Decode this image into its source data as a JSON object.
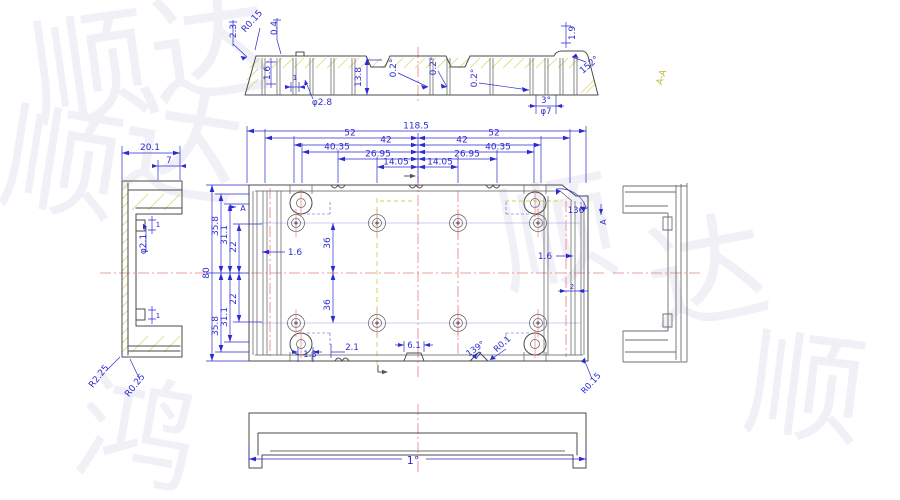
{
  "drawing": {
    "type": "cad-engineering-drawing",
    "part": "plastic-enclosure-base",
    "views": [
      "section A-A (top)",
      "left side view",
      "plan view",
      "right side view",
      "bottom view"
    ],
    "colors": {
      "dimension_blue": "#2b2bd2",
      "part_line": "#4b4b4b",
      "centerline_red": "#e87e7e",
      "hatch_yellow": "#ddd573",
      "section_label_olive": "#bdb52d",
      "construction_blue": "#9a9ae0",
      "watermark_gray": "#f1f0f7",
      "background": "#ffffff"
    }
  },
  "labels": {
    "section": {
      "d23": "2.3",
      "r015": "R0.15",
      "d04": "0.4",
      "d16": "1.6",
      "d138": "13.8",
      "d1": "1",
      "dia28": "φ2.8",
      "a02a": "0.2°",
      "a02b": "0.2°",
      "a02c": "0.2°",
      "d19": "1.9",
      "a152": "152°",
      "a3": "3°",
      "dia7": "φ7",
      "view_label": "A-A"
    },
    "left_view": {
      "d201": "20.1",
      "d7": "7",
      "dia21": "φ2.1",
      "d1t": "1",
      "d1b": "1",
      "r225": "R2.25",
      "r025": "R0.25"
    },
    "plan": {
      "d1185": "118.5",
      "d52l": "52",
      "d52r": "52",
      "d42l": "42",
      "d42r": "42",
      "d4035l": "40.35",
      "d4035r": "40.35",
      "d2695l": "26.95",
      "d2695r": "26.95",
      "d1405l": "14.05",
      "d1405r": "14.05",
      "d80": "80",
      "d358t": "35.8",
      "d311t": "31.1",
      "d22t": "22",
      "d22b": "22",
      "d311b": "31.1",
      "d358b": "35.8",
      "d36t": "36",
      "d36b": "36",
      "d16l": "1.6",
      "d16r": "1.6",
      "d2": "2",
      "d13": "1.3",
      "d21": "2.1",
      "d61": "6.1",
      "a139": "139°",
      "r01": "R0.1",
      "r015": "R0.15",
      "a136": "136°",
      "mark_a_left": "A",
      "mark_a_right": "A"
    },
    "bottom_view": {
      "a1": "1°"
    },
    "watermark": {
      "c0": "顺",
      "c1": "达",
      "c2": "顺",
      "c3": "达",
      "c4": "顺",
      "c5": "达",
      "c6": "鸿",
      "c7": "顺"
    }
  }
}
